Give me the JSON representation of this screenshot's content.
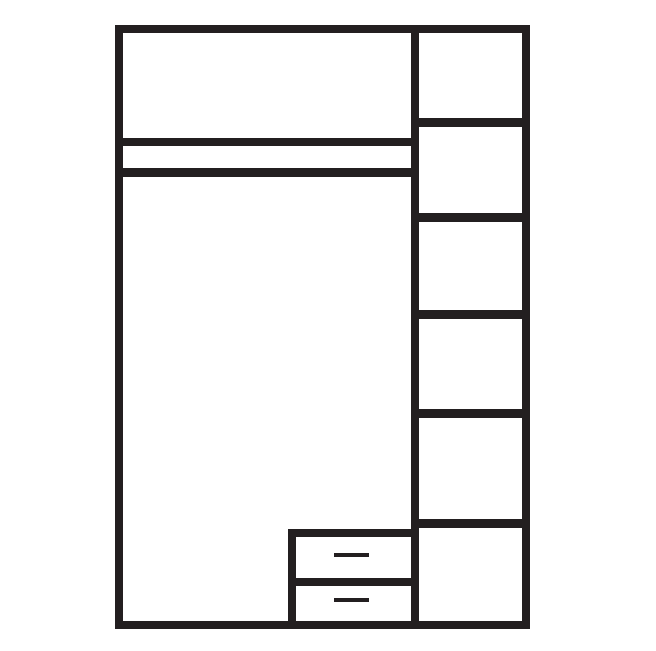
{
  "diagram": {
    "type": "wardrobe-front-elevation-line-drawing",
    "left_section": {
      "top_compartment": "overhead storage compartment",
      "shelf_band": "double-line shelf rail band",
      "main_compartment": "tall hanging space",
      "drawer_unit": {
        "drawer_count": 2,
        "handle_count": 2,
        "handle_style": "horizontal dash"
      }
    },
    "right_column": {
      "shelf_compartment_count": 6
    }
  },
  "colors": {
    "line": "#231f20",
    "background": "#ffffff"
  }
}
